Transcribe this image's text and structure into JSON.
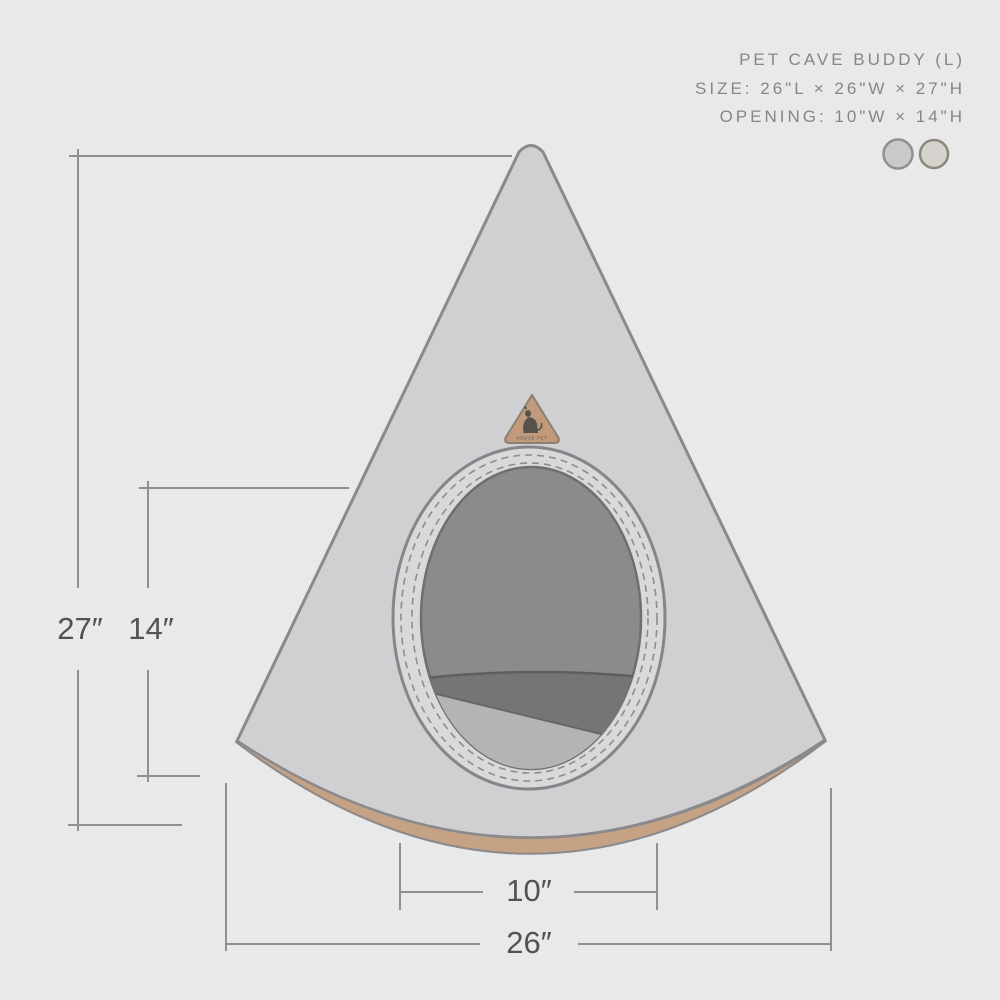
{
  "header": {
    "title": "PET CAVE BUDDY (L)",
    "size": "SIZE: 26\"L × 26\"W × 27\"H",
    "opening": "OPENING: 10\"W × 14\"H"
  },
  "dimension_labels": {
    "total_height": "27″",
    "opening_height": "14″",
    "opening_width": "10″",
    "base_width": "26″"
  },
  "badge": {
    "label": "HOUSE PET"
  },
  "swatches": [
    {
      "name": "cool-gray",
      "fill": "#c9c9cb",
      "stroke": "#8f8f92"
    },
    {
      "name": "warm-beige",
      "fill": "#d6d3ce",
      "stroke": "#8d887d"
    }
  ],
  "colors": {
    "background": "#e9e9ea",
    "cone_body": "#d0d0d2",
    "rim_face": "#d9d9da",
    "base_trim": "#c6a285",
    "opening_interior": "#8b8b8d",
    "interior_shadow": "#757578",
    "cushion": "#b4b4b6",
    "outline": "#85858a",
    "dimension_line": "#8f9093",
    "dimension_text": "#515257",
    "header_text": "#85868b",
    "badge_fill": "#c09a7b"
  }
}
